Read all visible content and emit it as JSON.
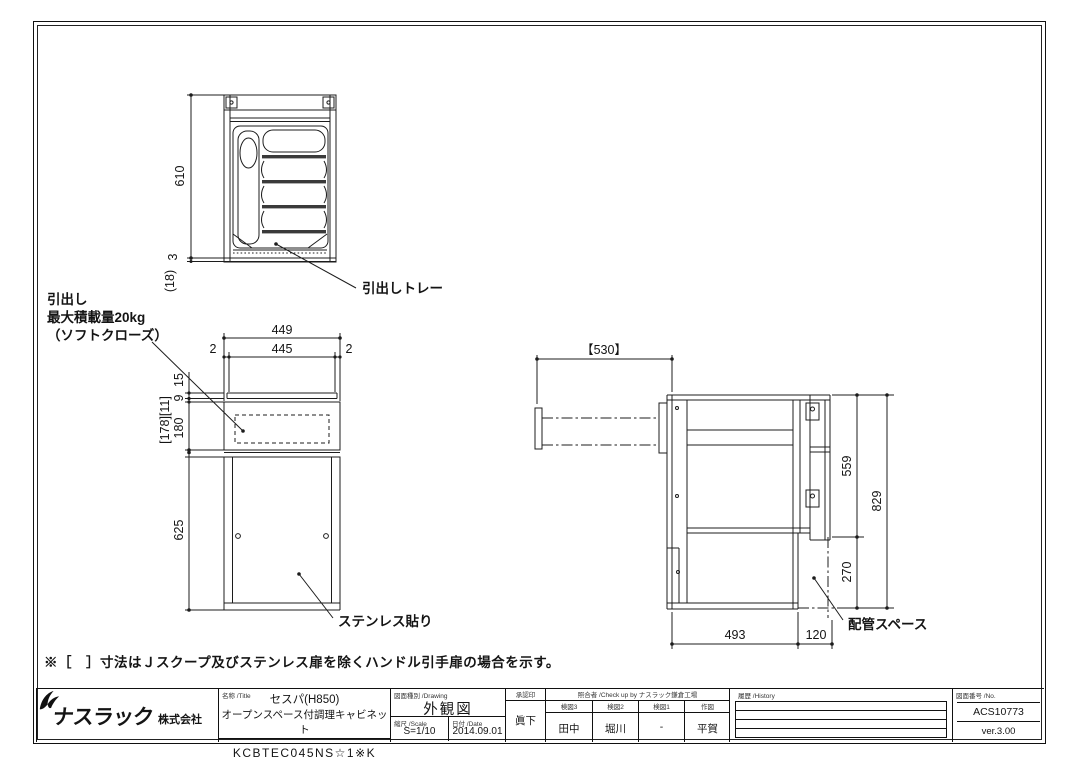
{
  "note": "※［　］寸法はＪスクープ及びステンレス扉を除くハンドル引手扉の場合を示す。",
  "top_view": {
    "dim_height": "610",
    "dim_base": "3",
    "dim_toe": "(18)",
    "callout_tray": "引出しトレー"
  },
  "front_view": {
    "dim_width": "449",
    "dim_inner_width": "445",
    "dim_left": "2",
    "dim_right": "2",
    "dim_top": "15",
    "dim_gap": "9",
    "dim_drawer_bracket": "[178][11]",
    "dim_drawer": "180",
    "dim_open": "625",
    "callout_drawer_1": "引出し",
    "callout_drawer_2": "最大積載量20kg",
    "callout_drawer_3": "（ソフトクローズ）",
    "callout_stainless": "ステンレス貼り"
  },
  "side_view": {
    "dim_pullout": "【530】",
    "dim_upper": "559",
    "dim_total": "829",
    "dim_lower": "270",
    "dim_depth": "493",
    "dim_back": "120",
    "callout_pipe": "配管スペース"
  },
  "title_block": {
    "company": {
      "name": "ナスラック",
      "suffix": "株式会社"
    },
    "title": {
      "header": "名称 /Title",
      "series": "セスパ(H850)",
      "product": "オープンスペース付調理キャビネット",
      "model": "KCBTEC045NS☆1※K"
    },
    "drawing": {
      "header": "図面種別 /Drawing",
      "value": "外観図"
    },
    "scale": {
      "header": "縮尺 /Scale",
      "value": "S=1/10"
    },
    "date": {
      "header": "日付 /Date",
      "value": "2014.09.01"
    },
    "approval": {
      "header": "承認印",
      "value": "眞下"
    },
    "check": {
      "header": "照合者 /Check up by ナスラック鎌倉工場",
      "columns": [
        {
          "header": "検図3",
          "value": "田中"
        },
        {
          "header": "検図2",
          "value": "堀川"
        },
        {
          "header": "検図1",
          "value": "-"
        },
        {
          "header": "作図",
          "value": "平賀"
        }
      ]
    },
    "history": {
      "header": "履歴 /History"
    },
    "number": {
      "header": "図面番号 /No.",
      "value": "ACS10773",
      "version": "ver.3.00"
    }
  }
}
